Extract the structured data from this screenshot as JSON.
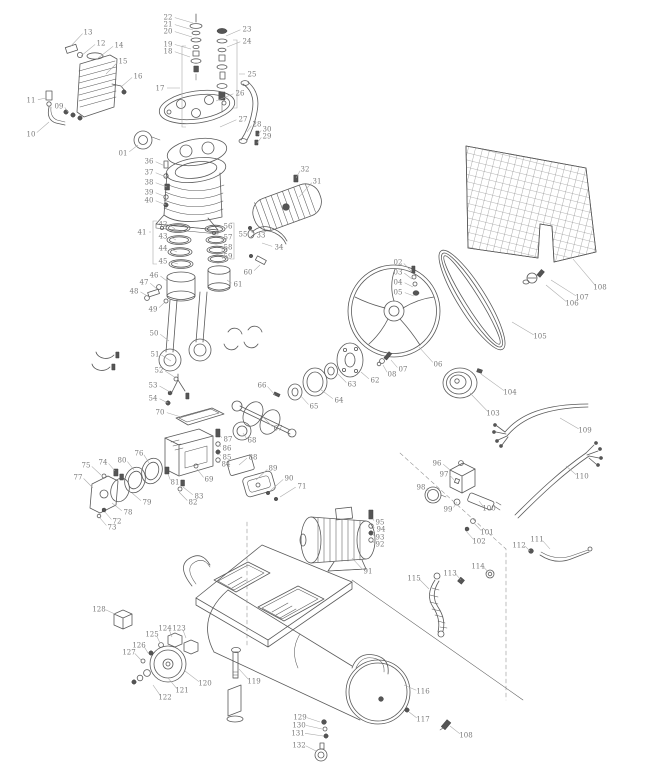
{
  "diagram": {
    "kind": "exploded-parts-diagram",
    "canvas": {
      "width": 646,
      "height": 768,
      "background": "#ffffff"
    },
    "style": {
      "line_color": "#5a5a5a",
      "label_color": "#7a7a7a",
      "leader_color": "#a9a9a9",
      "dash_color": "#8a8a8a",
      "mesh_color": "#6a6a6a",
      "label_font_size": 7
    },
    "label_format": [
      "number",
      "x",
      "y",
      "target_x",
      "target_y"
    ],
    "part_labels": [
      [
        "01",
        123,
        153,
        138,
        145
      ],
      [
        "02",
        398,
        262,
        411,
        271
      ],
      [
        "03",
        398,
        272,
        412,
        279
      ],
      [
        "04",
        398,
        282,
        413,
        287
      ],
      [
        "05",
        398,
        292,
        414,
        296
      ],
      [
        "06",
        438,
        364,
        419,
        347
      ],
      [
        "07",
        403,
        369,
        391,
        360
      ],
      [
        "08",
        392,
        374,
        383,
        365
      ],
      [
        "09",
        59,
        106,
        68,
        112
      ],
      [
        "10",
        31,
        134,
        49,
        122
      ],
      [
        "11",
        31,
        100,
        46,
        98
      ],
      [
        "12",
        101,
        43,
        81,
        56
      ],
      [
        "13",
        88,
        32,
        70,
        47
      ],
      [
        "14",
        119,
        45,
        97,
        59
      ],
      [
        "15",
        123,
        61,
        106,
        74
      ],
      [
        "16",
        138,
        76,
        121,
        87
      ],
      [
        "17",
        160,
        88,
        180,
        88
      ],
      [
        "18",
        168,
        51,
        190,
        57
      ],
      [
        "19",
        168,
        44,
        191,
        49
      ],
      [
        "20",
        168,
        31,
        192,
        37
      ],
      [
        "21",
        168,
        24,
        193,
        30
      ],
      [
        "22",
        168,
        17,
        193,
        23
      ],
      [
        "23",
        247,
        29,
        226,
        36
      ],
      [
        "24",
        247,
        41,
        227,
        47
      ],
      [
        "25",
        252,
        74,
        239,
        74
      ],
      [
        "26",
        240,
        93,
        216,
        101
      ],
      [
        "27",
        243,
        119,
        220,
        127
      ],
      [
        "28",
        257,
        124,
        247,
        132
      ],
      [
        "29",
        267,
        136,
        257,
        143
      ],
      [
        "30",
        267,
        129,
        258,
        135
      ],
      [
        "31",
        317,
        181,
        299,
        197
      ],
      [
        "32",
        305,
        169,
        296,
        178
      ],
      [
        "33",
        261,
        235,
        250,
        230
      ],
      [
        "34",
        279,
        247,
        262,
        243
      ],
      [
        "36",
        149,
        161,
        165,
        166
      ],
      [
        "37",
        149,
        172,
        166,
        177
      ],
      [
        "38",
        149,
        182,
        167,
        187
      ],
      [
        "39",
        149,
        192,
        166,
        197
      ],
      [
        "40",
        149,
        200,
        166,
        205
      ],
      [
        "41",
        142,
        232,
        151,
        232
      ],
      [
        "42",
        163,
        224,
        175,
        229
      ],
      [
        "43",
        163,
        236,
        176,
        240
      ],
      [
        "44",
        163,
        248,
        177,
        252
      ],
      [
        "45",
        163,
        261,
        178,
        264
      ],
      [
        "46",
        154,
        275,
        167,
        281
      ],
      [
        "47",
        144,
        282,
        157,
        289
      ],
      [
        "48",
        134,
        291,
        149,
        297
      ],
      [
        "49",
        153,
        309,
        165,
        302
      ],
      [
        "50",
        154,
        333,
        169,
        341
      ],
      [
        "51",
        155,
        354,
        171,
        361
      ],
      [
        "52",
        159,
        370,
        176,
        378
      ],
      [
        "53",
        153,
        385,
        170,
        392
      ],
      [
        "54",
        153,
        398,
        168,
        403
      ],
      [
        "55",
        243,
        234,
        236,
        234
      ],
      [
        "56",
        228,
        226,
        221,
        229
      ],
      [
        "57",
        228,
        237,
        222,
        241
      ],
      [
        "58",
        228,
        247,
        222,
        251
      ],
      [
        "59",
        228,
        256,
        223,
        259
      ],
      [
        "60",
        248,
        272,
        260,
        265
      ],
      [
        "61",
        238,
        284,
        227,
        280
      ],
      [
        "62",
        375,
        380,
        361,
        372
      ],
      [
        "63",
        352,
        384,
        338,
        374
      ],
      [
        "64",
        339,
        400,
        320,
        389
      ],
      [
        "65",
        314,
        406,
        300,
        395
      ],
      [
        "66",
        262,
        385,
        275,
        395
      ],
      [
        "67",
        278,
        428,
        263,
        417
      ],
      [
        "68",
        252,
        440,
        243,
        433
      ],
      [
        "69",
        209,
        479,
        197,
        469
      ],
      [
        "70",
        160,
        412,
        181,
        417
      ],
      [
        "71",
        302,
        486,
        280,
        497
      ],
      [
        "72",
        117,
        521,
        105,
        512
      ],
      [
        "73",
        112,
        527,
        100,
        518
      ],
      [
        "74",
        103,
        462,
        115,
        471
      ],
      [
        "75",
        86,
        465,
        101,
        475
      ],
      [
        "76",
        139,
        453,
        149,
        463
      ],
      [
        "77",
        78,
        477,
        93,
        488
      ],
      [
        "78",
        128,
        512,
        112,
        503
      ],
      [
        "79",
        147,
        502,
        132,
        493
      ],
      [
        "80",
        122,
        460,
        134,
        470
      ],
      [
        "81",
        175,
        482,
        168,
        474
      ],
      [
        "82",
        193,
        502,
        179,
        492
      ],
      [
        "83",
        199,
        496,
        183,
        487
      ],
      [
        "84",
        226,
        464,
        219,
        461
      ],
      [
        "85",
        227,
        457,
        219,
        453
      ],
      [
        "86",
        227,
        448,
        219,
        444
      ],
      [
        "87",
        228,
        439,
        220,
        435
      ],
      [
        "88",
        253,
        457,
        239,
        465
      ],
      [
        "89",
        273,
        468,
        256,
        480
      ],
      [
        "90",
        289,
        478,
        270,
        491
      ],
      [
        "91",
        368,
        571,
        352,
        558
      ],
      [
        "92",
        380,
        544,
        373,
        540
      ],
      [
        "93",
        380,
        537,
        373,
        533
      ],
      [
        "94",
        381,
        529,
        373,
        526
      ],
      [
        "95",
        380,
        522,
        373,
        518
      ],
      [
        "96",
        437,
        463,
        450,
        470
      ],
      [
        "97",
        444,
        474,
        455,
        481
      ],
      [
        "98",
        421,
        487,
        429,
        492
      ],
      [
        "99",
        448,
        509,
        457,
        502
      ],
      [
        "100",
        489,
        508,
        479,
        501
      ],
      [
        "101",
        487,
        532,
        474,
        523
      ],
      [
        "102",
        479,
        541,
        466,
        531
      ],
      [
        "103",
        493,
        413,
        470,
        393
      ],
      [
        "104",
        510,
        392,
        481,
        374
      ],
      [
        "105",
        540,
        336,
        512,
        322
      ],
      [
        "106",
        572,
        303,
        546,
        285
      ],
      [
        "107",
        582,
        297,
        551,
        280
      ],
      [
        "108",
        600,
        287,
        573,
        259
      ],
      [
        "108",
        466,
        735,
        450,
        726
      ],
      [
        "109",
        585,
        430,
        560,
        418
      ],
      [
        "110",
        582,
        476,
        566,
        466
      ],
      [
        "111",
        537,
        539,
        550,
        549
      ],
      [
        "112",
        519,
        545,
        530,
        551
      ],
      [
        "113",
        450,
        573,
        461,
        580
      ],
      [
        "114",
        478,
        566,
        489,
        573
      ],
      [
        "115",
        414,
        578,
        429,
        589
      ],
      [
        "116",
        423,
        691,
        404,
        685
      ],
      [
        "117",
        423,
        719,
        409,
        712
      ],
      [
        "119",
        254,
        681,
        239,
        669
      ],
      [
        "120",
        205,
        683,
        185,
        671
      ],
      [
        "121",
        182,
        690,
        168,
        678
      ],
      [
        "122",
        165,
        697,
        153,
        685
      ],
      [
        "123",
        179,
        628,
        186,
        638
      ],
      [
        "124",
        165,
        628,
        172,
        637
      ],
      [
        "125",
        152,
        634,
        160,
        643
      ],
      [
        "126",
        139,
        645,
        148,
        653
      ],
      [
        "127",
        129,
        652,
        141,
        660
      ],
      [
        "128",
        99,
        609,
        117,
        615
      ],
      [
        "129",
        300,
        717,
        320,
        722
      ],
      [
        "130",
        299,
        725,
        322,
        729
      ],
      [
        "131",
        298,
        733,
        323,
        736
      ],
      [
        "132",
        299,
        745,
        316,
        751
      ]
    ],
    "brackets": [
      {
        "label": "17",
        "x": 182,
        "y1": 46,
        "y2": 127,
        "dir": 1
      },
      {
        "label": "25",
        "x": 237,
        "y1": 40,
        "y2": 108,
        "dir": -1
      },
      {
        "label": "41",
        "x": 153,
        "y1": 221,
        "y2": 264,
        "dir": 1
      },
      {
        "label": "55",
        "x": 234,
        "y1": 223,
        "y2": 259,
        "dir": -1
      }
    ]
  }
}
